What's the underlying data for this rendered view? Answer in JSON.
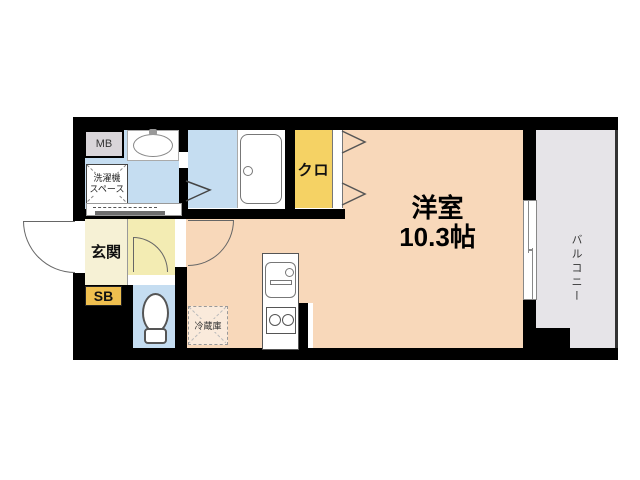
{
  "plan": {
    "rooms": {
      "main_room": {
        "name": "洋室",
        "size": "10.3帖"
      },
      "closet": {
        "label": "クロ"
      },
      "entrance": {
        "label": "玄関"
      },
      "shoe_box": {
        "label": "SB"
      },
      "meter_box": {
        "label": "MB"
      },
      "laundry_space": {
        "label_line1": "洗濯機",
        "label_line2": "スペース"
      },
      "refrigerator": {
        "label": "冷蔵庫"
      },
      "balcony": {
        "label": "バルコニー"
      }
    },
    "colors": {
      "wall": "#000000",
      "main_room_floor": "#F8D8BA",
      "wet_area_floor": "#C5DDF1",
      "entrance_floor": "#F6F1D5",
      "hall_floor": "#F3ECB3",
      "closet_fill": "#F5D264",
      "shoe_box_fill": "#EFBF4F",
      "meter_box_fill": "#D9D5D9",
      "balcony_floor": "#E6E4E8"
    }
  }
}
